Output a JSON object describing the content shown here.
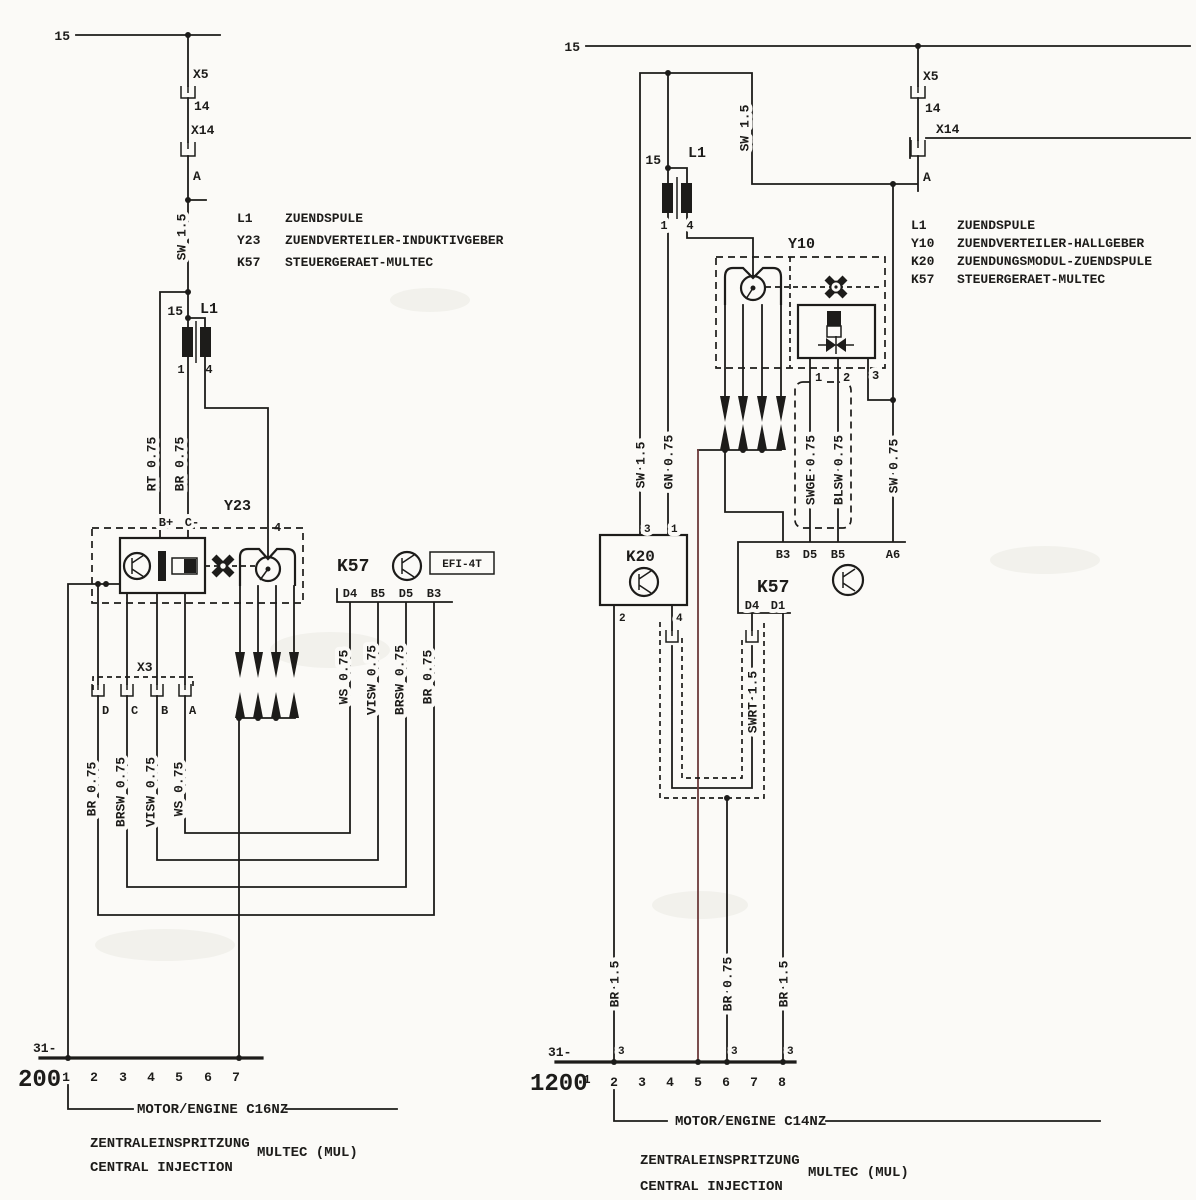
{
  "colors": {
    "ink": "#1d1c1a",
    "paper": "#fbfaf7",
    "scan_artifact_line": "#6d3b3b"
  },
  "left": {
    "feed": "15",
    "x5": "X5",
    "x5_pin": "14",
    "x14": "X14",
    "x14_pin": "A",
    "w_sw": "SW 1.5",
    "l1": {
      "name": "L1",
      "t15": "15",
      "t1": "1",
      "t4": "4"
    },
    "w_rt": "RT 0.75",
    "w_br": "BR 0.75",
    "y23": {
      "name": "Y23",
      "bplus": "B+",
      "cminus": "C-",
      "p4": "4"
    },
    "k57": {
      "name": "K57",
      "tag": "EFI-4T",
      "pins": [
        "D4",
        "B5",
        "D5",
        "B3"
      ],
      "wires": [
        "WS 0.75",
        "VISW 0.75",
        "BRSW 0.75",
        "BR 0.75"
      ]
    },
    "x3": {
      "name": "X3",
      "pins": [
        "D",
        "C",
        "B",
        "A"
      ],
      "wires": [
        "BR 0.75",
        "BRSW 0.75",
        "VISW 0.75",
        "WS 0.75"
      ]
    },
    "bus": {
      "terminal": "31-",
      "page": "200",
      "tracks": [
        "1",
        "2",
        "3",
        "4",
        "5",
        "6",
        "7"
      ]
    },
    "footer": {
      "engine": "MOTOR/ENGINE C16NZ",
      "system_de": "ZENTRALEINSPRITZUNG",
      "system_en": "CENTRAL INJECTION",
      "system": "MULTEC (MUL)"
    },
    "legend": [
      {
        "key": "L1",
        "desc": "ZUENDSPULE"
      },
      {
        "key": "Y23",
        "desc": "ZUENDVERTEILER-INDUKTIVGEBER"
      },
      {
        "key": "K57",
        "desc": "STEUERGERAET-MULTEC"
      }
    ]
  },
  "right": {
    "feed": "15",
    "x5": "X5",
    "x5_pin": "14",
    "x14": "X14",
    "x14_pin": "A",
    "w_sw_top": "SW 1.5",
    "l1": {
      "name": "L1",
      "t15": "15",
      "t1": "1",
      "t4": "4"
    },
    "w_sw": "SW 1.5",
    "w_gn": "GN 0.75",
    "y10": {
      "name": "Y10",
      "pins": [
        "1",
        "2",
        "3"
      ]
    },
    "w_swge": "SWGE 0.75",
    "w_blsw": "BLSW 0.75",
    "w_sw075": "SW 0.75",
    "k20": {
      "name": "K20",
      "p3": "3",
      "p1": "1",
      "p2": "2",
      "p4": "4"
    },
    "k57": {
      "name": "K57",
      "top": [
        "B3",
        "D5",
        "B5",
        "A6"
      ],
      "bottom": [
        "D4",
        "D1"
      ]
    },
    "w_swrt": "SWRT 1.5",
    "w_br15a": "BR 1.5",
    "w_br075": "BR 0.75",
    "w_br15b": "BR 1.5",
    "threes": [
      "3",
      "3",
      "3"
    ],
    "bus": {
      "terminal": "31-",
      "page": "1200",
      "tracks": [
        "1",
        "2",
        "3",
        "4",
        "5",
        "6",
        "7",
        "8"
      ]
    },
    "footer": {
      "engine": "MOTOR/ENGINE C14NZ",
      "system_de": "ZENTRALEINSPRITZUNG",
      "system_en": "CENTRAL INJECTION",
      "system": "MULTEC (MUL)"
    },
    "legend": [
      {
        "key": "L1",
        "desc": "ZUENDSPULE"
      },
      {
        "key": "Y10",
        "desc": "ZUENDVERTEILER-HALLGEBER"
      },
      {
        "key": "K20",
        "desc": "ZUENDUNGSMODUL-ZUENDSPULE"
      },
      {
        "key": "K57",
        "desc": "STEUERGERAET-MULTEC"
      }
    ]
  }
}
